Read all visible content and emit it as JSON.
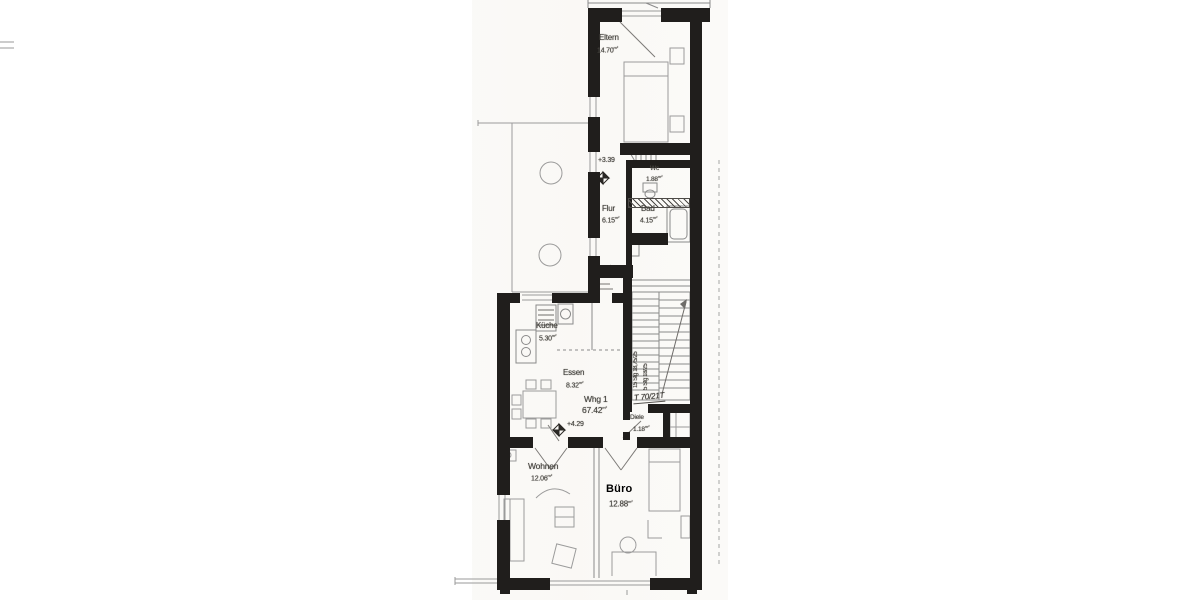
{
  "plan": {
    "title_note": "Floor plan scan (attic apartment)",
    "apartment": {
      "label": "Whg 1",
      "area": "67.42"
    },
    "area_unit": "m²",
    "rooms": [
      {
        "id": "eltern",
        "label": "Eltern",
        "area": "14.70"
      },
      {
        "id": "wc",
        "label": "Wc",
        "area": "1.88"
      },
      {
        "id": "flur",
        "label": "Flur",
        "area": "6.15"
      },
      {
        "id": "bad",
        "label": "Bad",
        "area": "4.15"
      },
      {
        "id": "kueche",
        "label": "Küche",
        "area": "5.30"
      },
      {
        "id": "essen",
        "label": "Essen",
        "area": "8.32"
      },
      {
        "id": "diele",
        "label": "Diele",
        "area": "1.18"
      },
      {
        "id": "wohnen",
        "label": "Wohnen",
        "area": "12.06"
      },
      {
        "id": "buero",
        "label": "Büro",
        "area": "12.88"
      }
    ],
    "elevations": [
      {
        "label": "+3.39"
      },
      {
        "label": "+4.29"
      }
    ],
    "annotations": {
      "door_note": "T 70/21T",
      "stair_note_main": "15 Stg 18,75/25",
      "stair_note_short": "5 Stg 18/25"
    },
    "colors": {
      "wall": "#201e1c",
      "thin_line": "#8a8a8a",
      "text": "#474540",
      "buero_text": "#000000",
      "paper": "#ffffff"
    }
  }
}
